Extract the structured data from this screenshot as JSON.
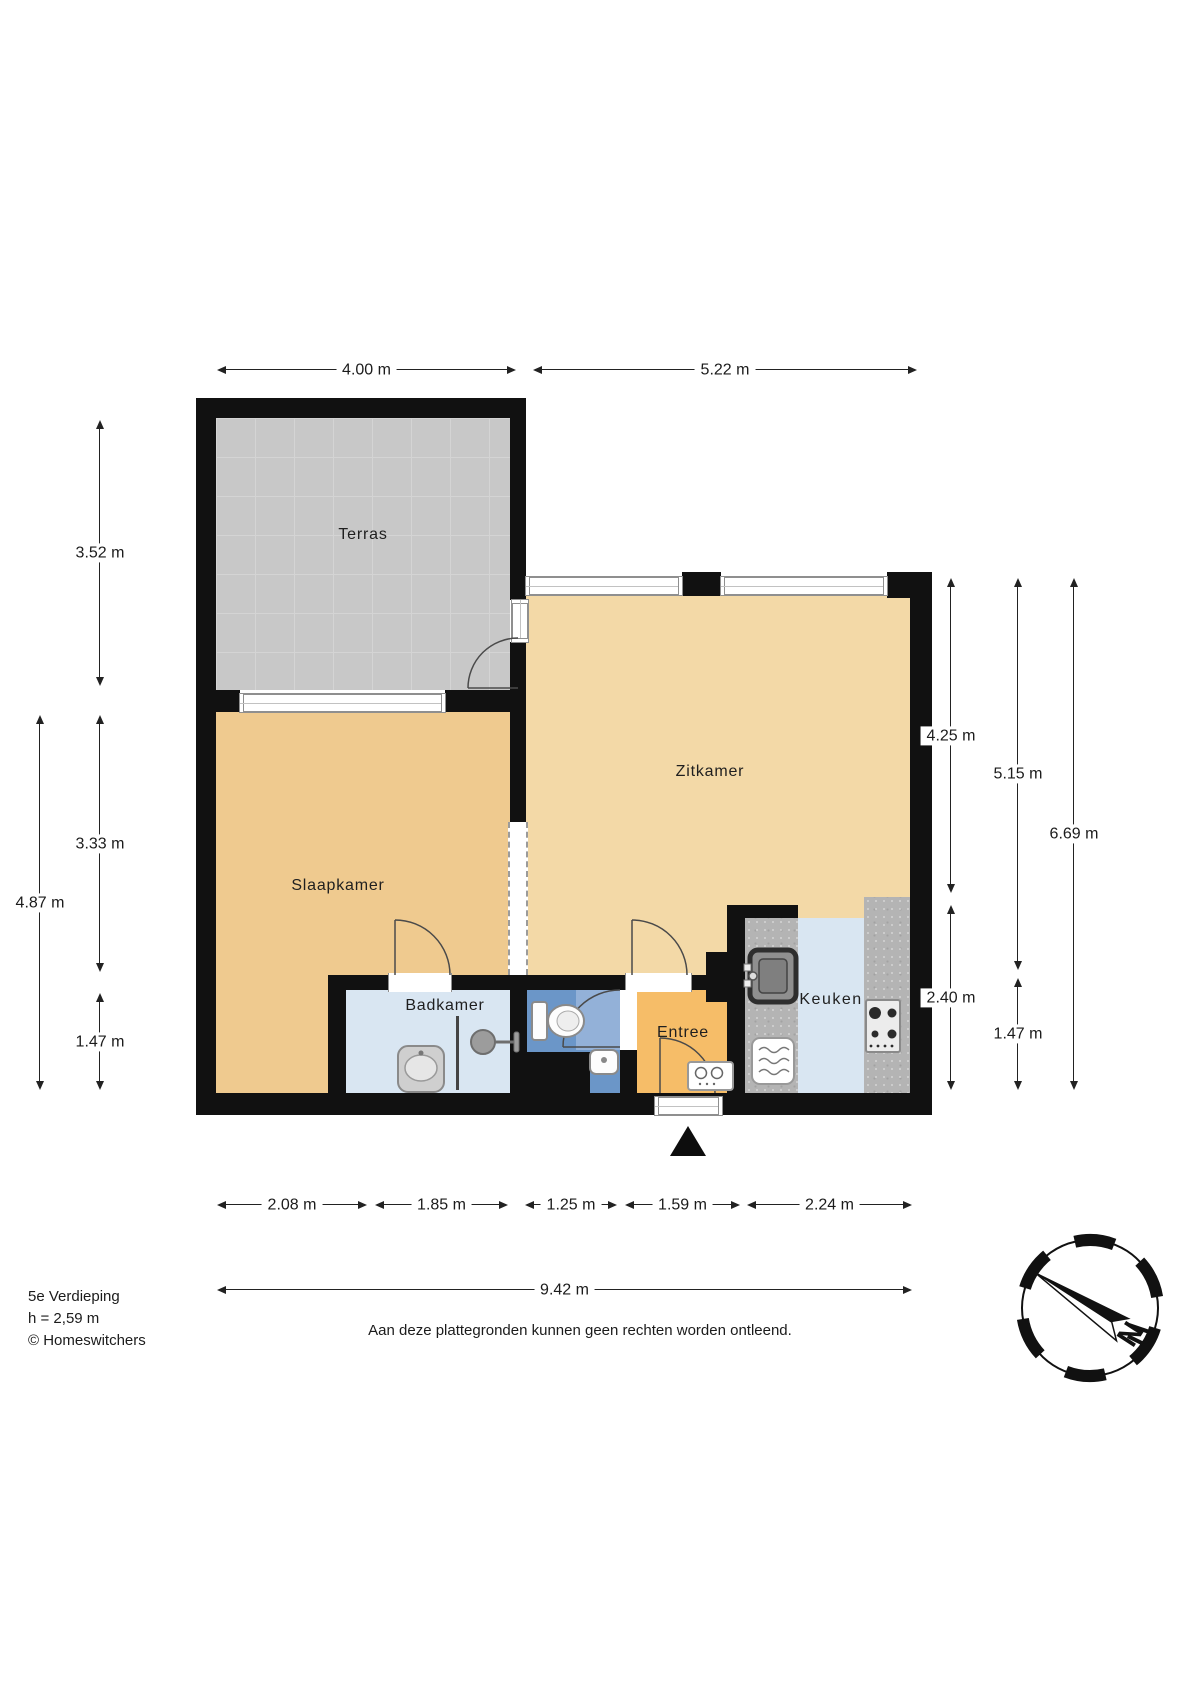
{
  "rooms": {
    "terras": "Terras",
    "zitkamer": "Zitkamer",
    "slaapkamer": "Slaapkamer",
    "badkamer": "Badkamer",
    "entree": "Entree",
    "keuken": "Keuken"
  },
  "dimensions": {
    "top": [
      "4.00 m",
      "5.22 m"
    ],
    "left": [
      "3.52 m",
      "3.33 m",
      "1.47 m"
    ],
    "left_total": "4.87 m",
    "right_col1": [
      "4.25 m",
      "2.40 m"
    ],
    "right_col2": [
      "5.15 m",
      "1.47 m"
    ],
    "right_total": "6.69 m",
    "bottom": [
      "2.08 m",
      "1.85 m",
      "1.25 m",
      "1.59 m",
      "2.24 m"
    ],
    "bottom_total": "9.42 m"
  },
  "footer": {
    "floor": "5e Verdieping",
    "ceiling_height": "h = 2,59 m",
    "credit": "© Homeswitchers",
    "disclaimer": "Aan deze plattegronden kunnen geen rechten worden ontleend."
  },
  "compass": {
    "north": "N"
  },
  "colors": {
    "wall": "#111111",
    "terras_floor": "#C8C8C8",
    "living_floor": "#F3D9A7",
    "bedroom_floor": "#EFCA8F",
    "entree_floor": "#F6BD68",
    "bathroom_floor": "#D9E6F2",
    "kitchen_floor": "#D9E6F2",
    "toilet_floor": "#6B96C8",
    "counter": "#B4B4B4"
  }
}
